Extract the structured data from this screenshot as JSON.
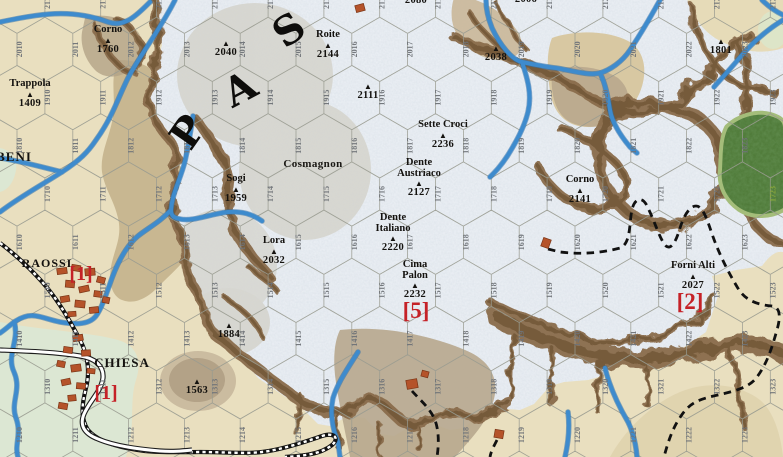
{
  "canvas": {
    "width": 783,
    "height": 457
  },
  "colors": {
    "plain": "#e9dfbf",
    "plain_band": "#d8cba3",
    "valley_olive": "#c8b791",
    "mud": "#b7a78d",
    "basin_light": "#d8c8a2",
    "basin_dark": "#bcab8f",
    "snow": "#edf1f6",
    "snow_speckle": "#9aa8b6",
    "gray_rock": "#d8d7d0",
    "ridge": "#8a6c4b",
    "ridge_dark": "#6d5334",
    "hill": "#b3a287",
    "hill_ring": "#cbbca0",
    "meadow": "#dce7d3",
    "forest": "#4d7836",
    "forest_fringe": "#a4bd7a",
    "river": "#3e8bcd",
    "river_edge": "#2d6da8",
    "road_fill": "#ffffff",
    "road_edge": "#1c1c1c",
    "rail": "#111111",
    "trail": "#111111",
    "building": "#b5532a",
    "building_edge": "#7a3516",
    "value_red": "#c52127",
    "text": "#14120f",
    "hex_line": "#999b90",
    "hex_label": "#6f7378",
    "hex_label_forest": "#8aa83c"
  },
  "big_letters": [
    {
      "ch": "P",
      "x": 188,
      "y": 132,
      "rot": -55
    },
    {
      "ch": "A",
      "x": 240,
      "y": 89,
      "rot": -28
    },
    {
      "ch": "S",
      "x": 289,
      "y": 30,
      "rot": -35
    }
  ],
  "peaks": [
    {
      "lines": [
        "Corno"
      ],
      "elev": "1760",
      "x": 108,
      "y": 25
    },
    {
      "lines": [
        "Trappola"
      ],
      "elev": "1409",
      "x": 30,
      "y": 79
    },
    {
      "lines": [],
      "elev": "2040",
      "x": 226,
      "y": 39
    },
    {
      "lines": [
        "Roite"
      ],
      "elev": "2144",
      "x": 328,
      "y": 30
    },
    {
      "lines": [],
      "elev": "2080",
      "x": 416,
      "y": -13
    },
    {
      "lines": [],
      "elev": "2006",
      "x": 526,
      "y": -14
    },
    {
      "lines": [],
      "elev": "2111",
      "x": 368,
      "y": 82
    },
    {
      "lines": [],
      "elev": "2038",
      "x": 496,
      "y": 44
    },
    {
      "lines": [],
      "elev": "1801",
      "x": 721,
      "y": 37
    },
    {
      "lines": [
        "Sette Croci"
      ],
      "elev": "2236",
      "x": 443,
      "y": 120
    },
    {
      "lines": [
        "Sogi"
      ],
      "elev": "1959",
      "x": 236,
      "y": 174
    },
    {
      "lines": [
        "Dente",
        "Austriaco"
      ],
      "elev": "2127",
      "x": 419,
      "y": 158
    },
    {
      "lines": [
        "Dente",
        "Italiano"
      ],
      "elev": "2220",
      "x": 393,
      "y": 213
    },
    {
      "lines": [
        "Lora"
      ],
      "elev": "2032",
      "x": 274,
      "y": 236
    },
    {
      "lines": [
        "Cima",
        "Palon"
      ],
      "elev": "2232",
      "x": 415,
      "y": 260
    },
    {
      "lines": [
        "Corno"
      ],
      "elev": "2141",
      "x": 580,
      "y": 175
    },
    {
      "lines": [
        "Forni Alti"
      ],
      "elev": "2027",
      "x": 693,
      "y": 261
    },
    {
      "lines": [],
      "elev": "1884",
      "x": 229,
      "y": 321
    },
    {
      "lines": [],
      "elev": "1563",
      "x": 197,
      "y": 377
    }
  ],
  "towns": [
    {
      "name": "BENI",
      "x": 14,
      "y": 149,
      "size": 13
    },
    {
      "name": "RAOSSI",
      "x": 47,
      "y": 256,
      "size": 12
    },
    {
      "name": "CHIESA",
      "x": 122,
      "y": 355,
      "size": 13
    }
  ],
  "area_labels": [
    {
      "text": "Cosmagnon",
      "x": 313,
      "y": 158
    }
  ],
  "strength_values": [
    {
      "text": "[1]",
      "x": 81,
      "y": 264,
      "size": 20
    },
    {
      "text": "[1]",
      "x": 106,
      "y": 383,
      "size": 20
    },
    {
      "text": "[5]",
      "x": 416,
      "y": 299,
      "size": 23
    },
    {
      "text": "[2]",
      "x": 690,
      "y": 290,
      "size": 23
    }
  ],
  "hex_grid": {
    "row_min": 12,
    "row_max": 21,
    "col_min": 10,
    "col_max": 23,
    "col_pitch": 55.8,
    "row_pitch": 48.2,
    "row12_y": 435,
    "even_row_x10": 17,
    "odd_row_offset": 27.9,
    "hex_size": 32.2,
    "special_labels": {
      "1723": "#8aa83c"
    }
  },
  "buildings": [
    {
      "x": 62,
      "y": 271,
      "w": 10,
      "h": 6,
      "r": -8
    },
    {
      "x": 76,
      "y": 268,
      "w": 9,
      "h": 6,
      "r": 10
    },
    {
      "x": 90,
      "y": 272,
      "w": 10,
      "h": 7,
      "r": -5
    },
    {
      "x": 101,
      "y": 280,
      "w": 8,
      "h": 6,
      "r": 15
    },
    {
      "x": 70,
      "y": 284,
      "w": 9,
      "h": 7,
      "r": 5
    },
    {
      "x": 84,
      "y": 289,
      "w": 10,
      "h": 6,
      "r": -12
    },
    {
      "x": 98,
      "y": 294,
      "w": 8,
      "h": 6,
      "r": 8
    },
    {
      "x": 65,
      "y": 299,
      "w": 9,
      "h": 6,
      "r": -10
    },
    {
      "x": 80,
      "y": 304,
      "w": 10,
      "h": 7,
      "r": 6
    },
    {
      "x": 94,
      "y": 310,
      "w": 9,
      "h": 6,
      "r": -6
    },
    {
      "x": 106,
      "y": 300,
      "w": 7,
      "h": 6,
      "r": 12
    },
    {
      "x": 72,
      "y": 314,
      "w": 8,
      "h": 5,
      "r": -4
    },
    {
      "x": 78,
      "y": 338,
      "w": 10,
      "h": 6,
      "r": -10
    },
    {
      "x": 68,
      "y": 350,
      "w": 9,
      "h": 6,
      "r": 8
    },
    {
      "x": 86,
      "y": 353,
      "w": 9,
      "h": 6,
      "r": -4
    },
    {
      "x": 61,
      "y": 364,
      "w": 8,
      "h": 6,
      "r": 12
    },
    {
      "x": 76,
      "y": 368,
      "w": 10,
      "h": 7,
      "r": -8
    },
    {
      "x": 91,
      "y": 371,
      "w": 8,
      "h": 5,
      "r": 6
    },
    {
      "x": 66,
      "y": 382,
      "w": 9,
      "h": 6,
      "r": -12
    },
    {
      "x": 81,
      "y": 386,
      "w": 9,
      "h": 6,
      "r": 5
    },
    {
      "x": 72,
      "y": 398,
      "w": 8,
      "h": 6,
      "r": -6
    },
    {
      "x": 63,
      "y": 406,
      "w": 9,
      "h": 6,
      "r": 10
    },
    {
      "x": 360,
      "y": 8,
      "w": 9,
      "h": 7,
      "r": -15
    },
    {
      "x": 546,
      "y": 243,
      "w": 8,
      "h": 9,
      "r": 20
    },
    {
      "x": 412,
      "y": 384,
      "w": 11,
      "h": 9,
      "r": -10
    },
    {
      "x": 425,
      "y": 374,
      "w": 7,
      "h": 6,
      "r": 15
    },
    {
      "x": 499,
      "y": 434,
      "w": 9,
      "h": 8,
      "r": 10
    }
  ]
}
